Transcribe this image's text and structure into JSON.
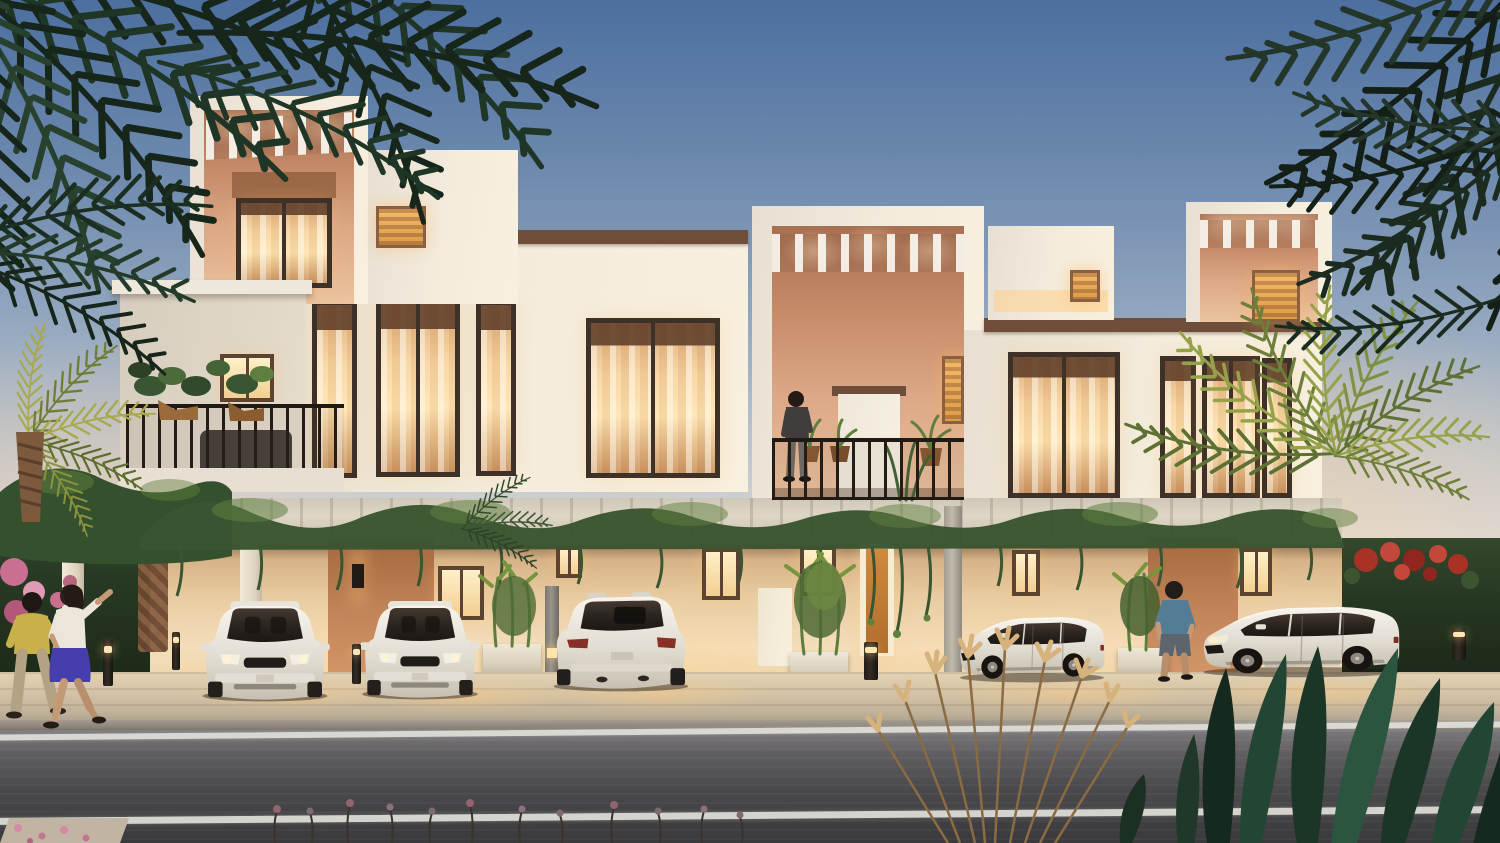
{
  "meta": {
    "image_type": "photorealistic architectural rendering",
    "time_of_day": "dusk",
    "subject": "row of modern two-storey townhouses with lit interiors, covered parking bays, landscaping and street"
  },
  "palette": {
    "skyTop": "#4d6f9f",
    "skyMid": "#93a7bf",
    "skyLow": "#d9d8d6",
    "skyWarm": "#f2e3cd",
    "facade": "#f0e9dc",
    "facadeShade": "#ddd5c7",
    "terracotta": "#dca887",
    "terracottaDeep": "#a86a4c",
    "copingBrown": "#6e4e3a",
    "frameBrown": "#3e3128",
    "glowBright": "#ffe5b2",
    "glowAmber": "#d99743",
    "groundWall": "#f4debb",
    "doorTerracotta": "#c08257",
    "vineDark": "#3a5531",
    "vineLight": "#5f7f3f",
    "palmDark": "#16261b",
    "palmLit": "#96a24a",
    "hedge": "#263722",
    "bougainvilleaPink": "#d4799c",
    "bougainvilleaRed": "#a93226",
    "pavement": "#d3c2a6",
    "curb": "#8b8378",
    "road": "#4c4b4e",
    "roadLine": "#dddcd5",
    "carBody": "#efece4",
    "carGlass": "#332c26",
    "pampasTan": "#c9a56e",
    "foregroundFoliage": "#20382a",
    "skin": "#c49a76"
  },
  "scene": {
    "buildings": {
      "storeys": 2,
      "features": [
        "rooftop pergola boxes",
        "terracotta recessed balconies",
        "slatted pergolas",
        "vine-covered trellis over parking",
        "warm lit floor-to-ceiling windows",
        "brown parapet copings"
      ]
    },
    "vehicles": [
      {
        "id": "car-suv-front-1",
        "description": "white luxury SUV, front view, parked in bay"
      },
      {
        "id": "car-suv-front-2",
        "description": "white luxury SUV, front view, parked in bay"
      },
      {
        "id": "car-suv-rear",
        "description": "white SUV, rear three-quarter view, parked in bay"
      },
      {
        "id": "car-compact-suv",
        "description": "white compact SUV, front three-quarter view"
      },
      {
        "id": "car-large-suv",
        "description": "white large SUV, front three-quarter view"
      }
    ],
    "people": [
      {
        "id": "walking-couple",
        "description": "woman in white top and blue skirt with man in yellow shirt walking on sidewalk"
      },
      {
        "id": "balcony-man",
        "description": "man standing on first-floor balcony"
      },
      {
        "id": "street-man",
        "description": "man in blue t-shirt walking near parked SUV"
      }
    ],
    "vegetation": [
      "dark palm fronds upper left",
      "dark palm fronds upper right",
      "lit palm crown mid right",
      "vine garland on trellis",
      "bamboo planters",
      "pink bougainvillea left",
      "red bougainvillea on right hedge",
      "pampas grass foreground",
      "dark strap-leaf plants foreground",
      "balcony planter pots"
    ],
    "street": {
      "lane_lines": 2,
      "bollard_lights": 5,
      "sidewalk": true
    }
  }
}
